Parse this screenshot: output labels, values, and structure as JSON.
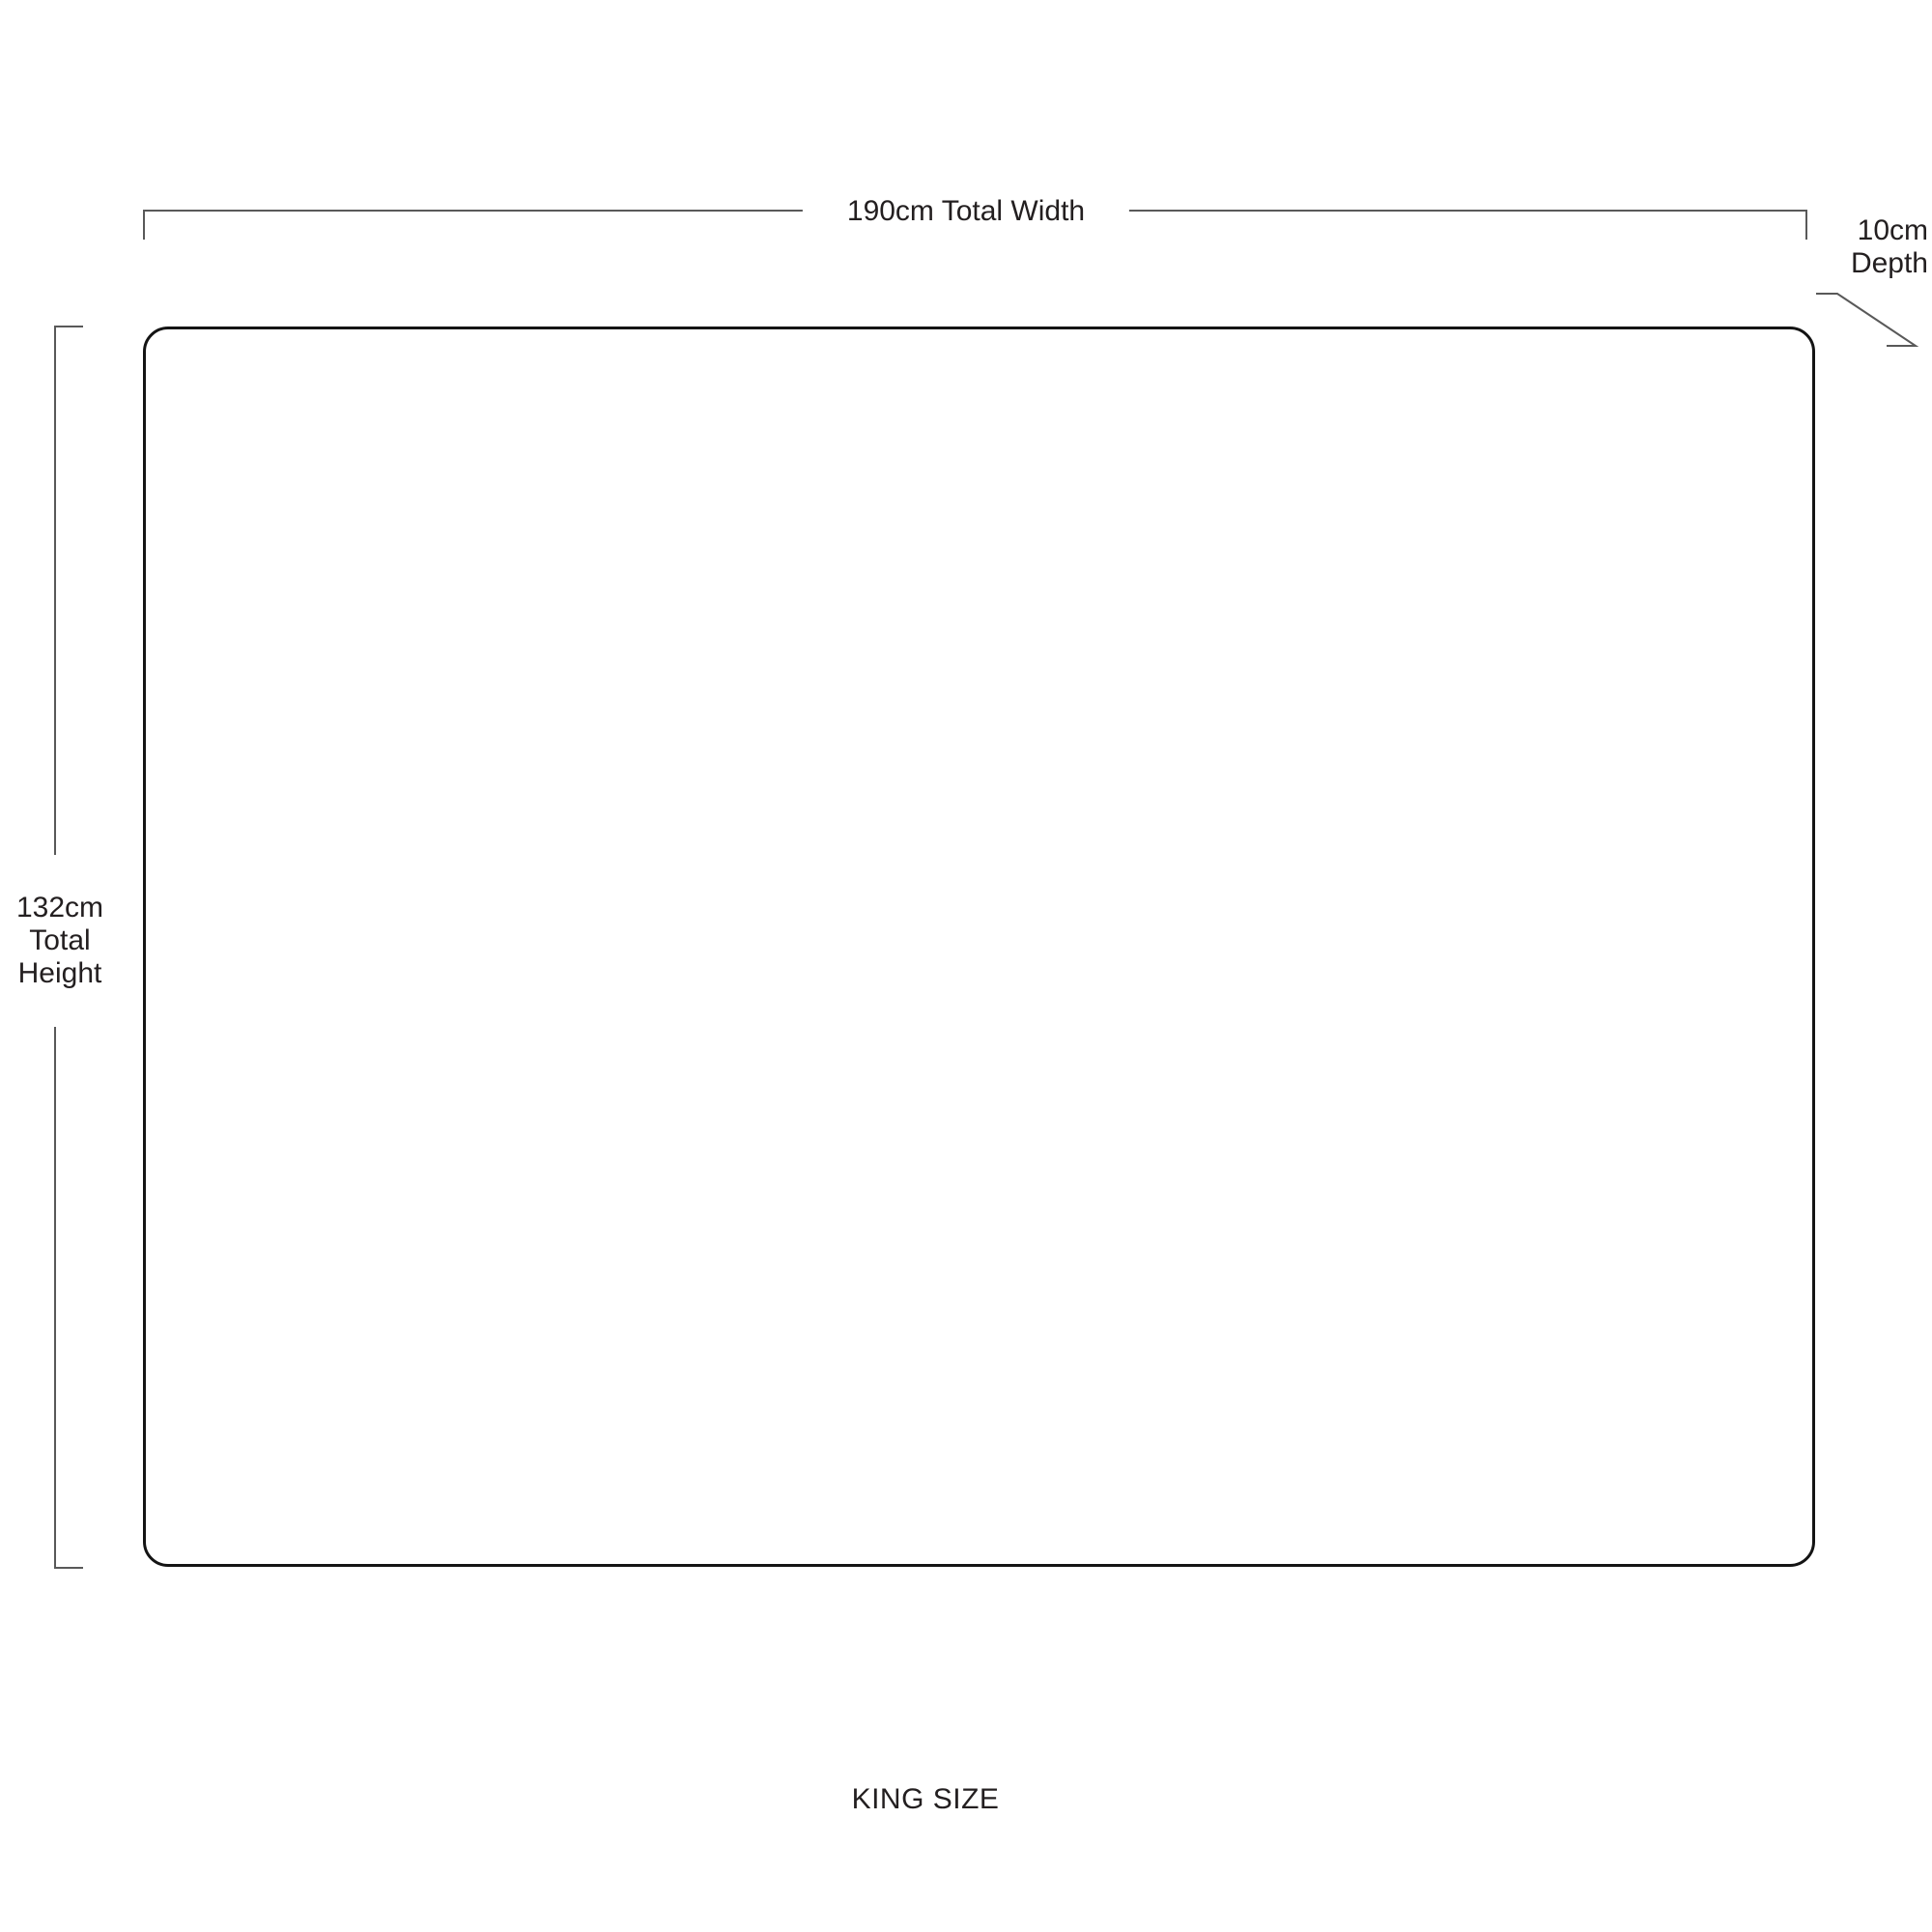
{
  "diagram": {
    "title": "KING SIZE",
    "labels": {
      "width": "190cm Total Width",
      "height": [
        "132cm",
        "Total",
        "Height"
      ],
      "depth": [
        "10cm",
        "Depth"
      ]
    },
    "dimensions": {
      "total_width_cm": 190,
      "total_height_cm": 132,
      "depth_cm": 10
    },
    "colors": {
      "background": "#ffffff",
      "outline": "#141414",
      "dimension_line": "#595959",
      "text": "#231f20"
    }
  }
}
